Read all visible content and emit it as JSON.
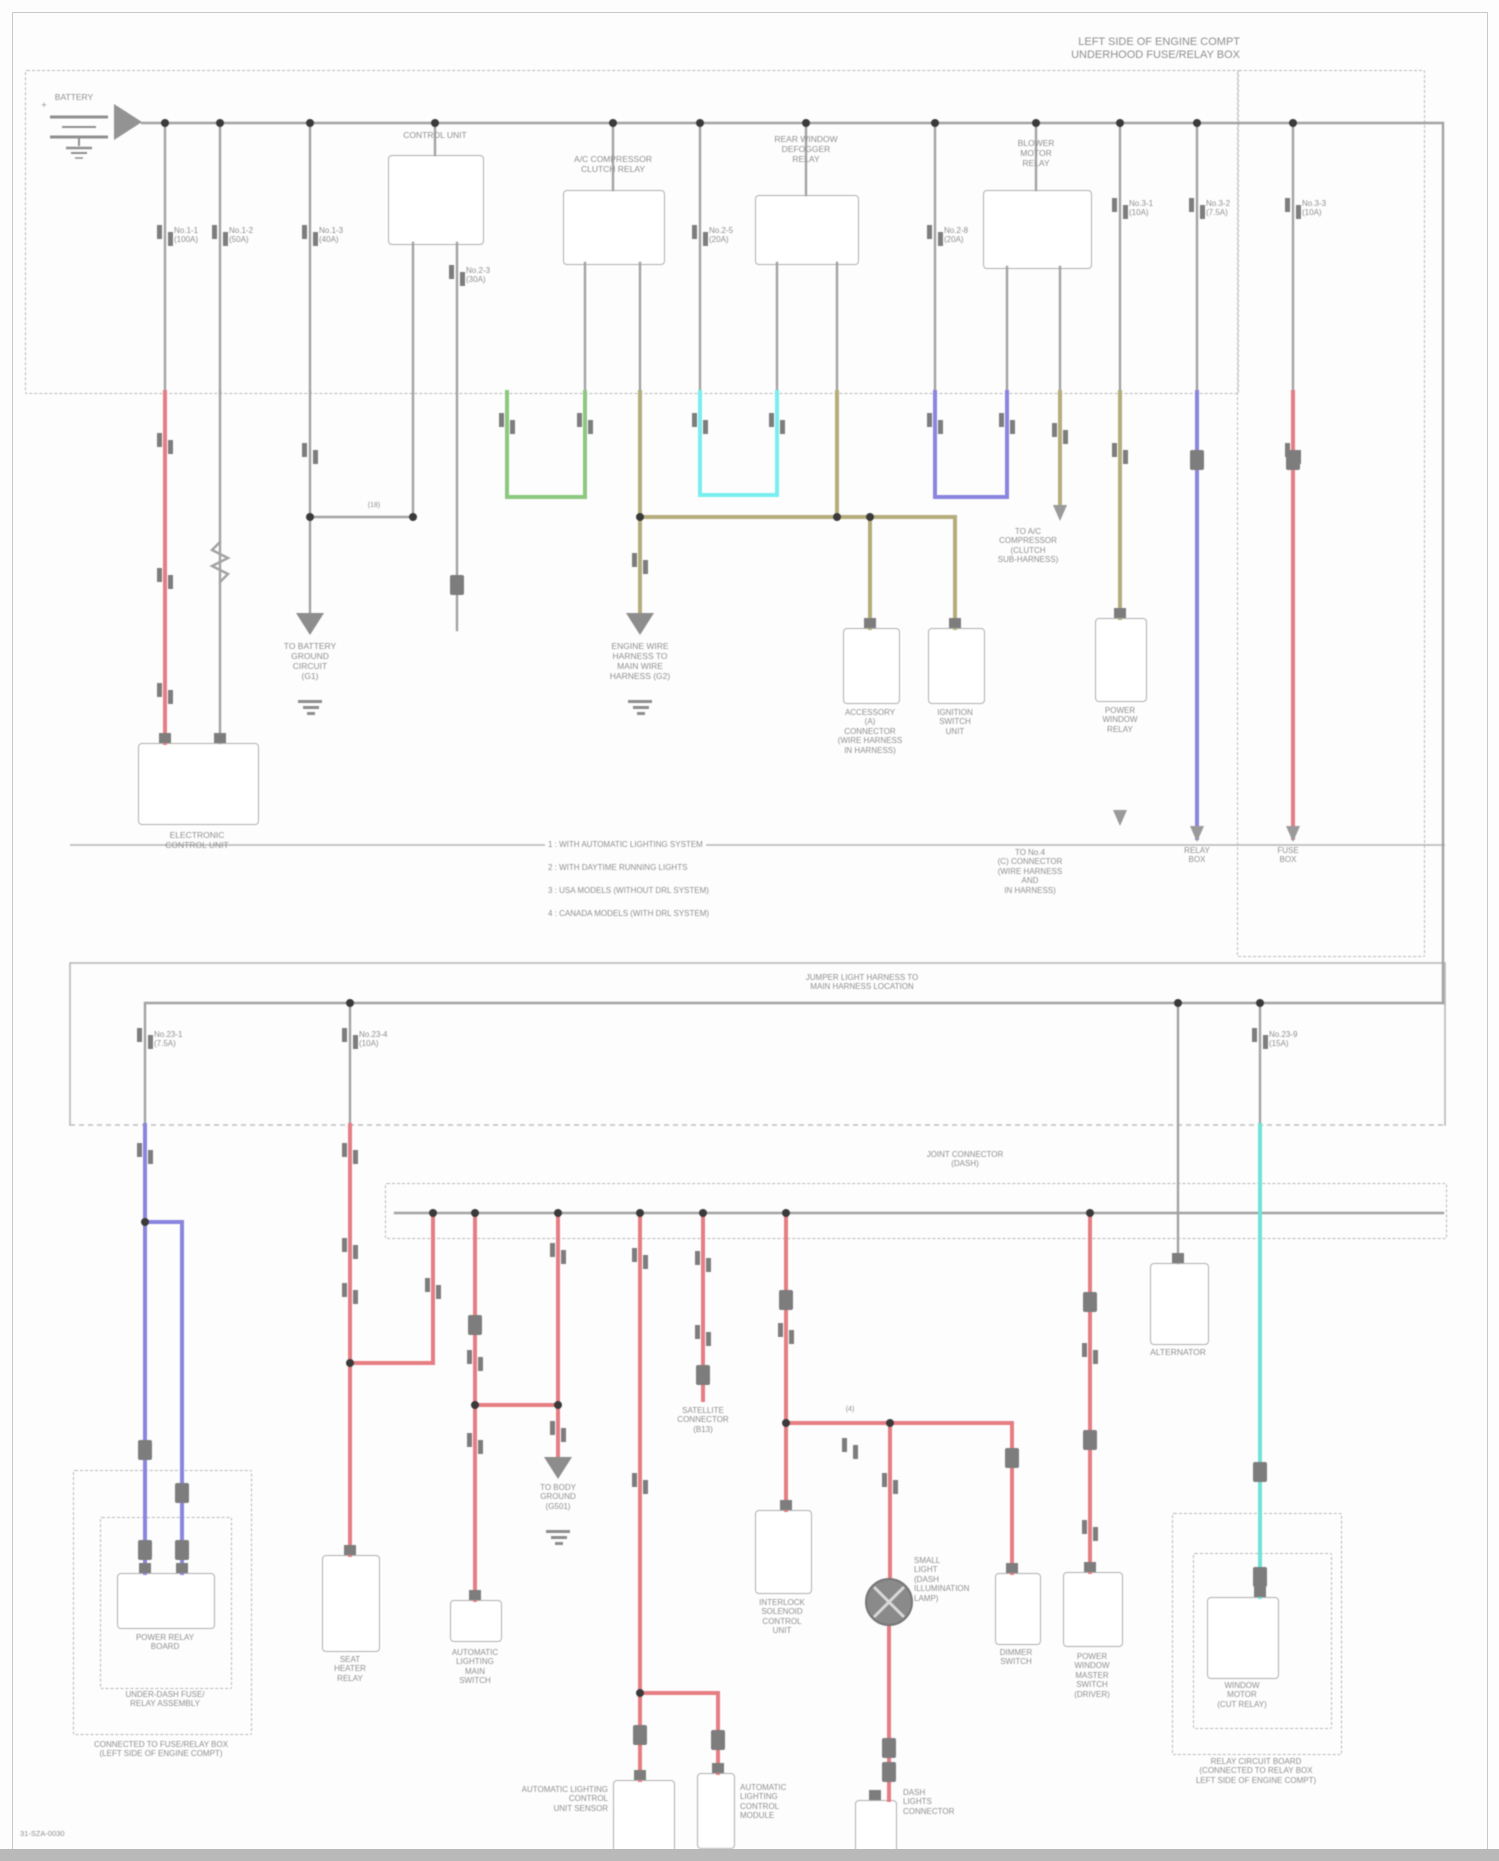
{
  "title": "POWER DISTRIBUTION WIRING DIAGRAM",
  "colors": {
    "red": "#e57d82",
    "green": "#8cc87f",
    "cyan": "#79eef0",
    "olive": "#b4ad7a",
    "blue": "#8a86e0",
    "teal": "#6fe3d6",
    "wire": "#a2a2a2",
    "text": "#8f8f8f",
    "border": "#b0b0b0"
  },
  "labels": [
    {
      "n": "corner-note",
      "x": 1240,
      "y": 36,
      "a": "r",
      "s": 11,
      "ls": [
        "LEFT SIDE OF ENGINE COMPT",
        "UNDERHOOD FUSE/RELAY BOX"
      ]
    },
    {
      "n": "battery-label",
      "x": 74,
      "y": 92,
      "a": "c",
      "ls": [
        "BATTERY"
      ]
    },
    {
      "n": "battery-plus",
      "x": 44,
      "y": 100,
      "a": "c",
      "s": 9,
      "ls": [
        "+"
      ]
    },
    {
      "n": "relay1-label",
      "x": 435,
      "y": 130,
      "a": "c",
      "ls": [
        "CONTROL UNIT"
      ]
    },
    {
      "n": "relay2-label",
      "x": 613,
      "y": 154,
      "a": "c",
      "ls": [
        "A/C COMPRESSOR",
        "CLUTCH RELAY"
      ]
    },
    {
      "n": "relay3-label",
      "x": 806,
      "y": 134,
      "a": "c",
      "ls": [
        "REAR WINDOW",
        "DEFOGGER",
        "RELAY"
      ]
    },
    {
      "n": "relay4-label",
      "x": 1036,
      "y": 138,
      "a": "c",
      "ls": [
        "BLOWER",
        "MOTOR",
        "RELAY"
      ]
    },
    {
      "n": "fuse-label-1",
      "x": 174,
      "y": 226,
      "a": "l",
      "s": 8,
      "ls": [
        "No.1-1",
        "(100A)"
      ]
    },
    {
      "n": "fuse-label-2",
      "x": 229,
      "y": 226,
      "a": "l",
      "s": 8,
      "ls": [
        "No.1-2",
        "(50A)"
      ]
    },
    {
      "n": "fuse-label-3",
      "x": 319,
      "y": 226,
      "a": "l",
      "s": 8,
      "ls": [
        "No.1-3",
        "(40A)"
      ]
    },
    {
      "n": "fuse-label-4",
      "x": 466,
      "y": 266,
      "a": "l",
      "s": 8,
      "ls": [
        "No.2-3",
        "(30A)"
      ]
    },
    {
      "n": "fuse-label-5",
      "x": 709,
      "y": 226,
      "a": "l",
      "s": 8,
      "ls": [
        "No.2-5",
        "(20A)"
      ]
    },
    {
      "n": "fuse-label-6",
      "x": 944,
      "y": 226,
      "a": "l",
      "s": 8,
      "ls": [
        "No.2-8",
        "(20A)"
      ]
    },
    {
      "n": "fuse-label-7",
      "x": 1129,
      "y": 199,
      "a": "l",
      "s": 8,
      "ls": [
        "No.3-1",
        "(10A)"
      ]
    },
    {
      "n": "fuse-label-8",
      "x": 1206,
      "y": 199,
      "a": "l",
      "s": 8,
      "ls": [
        "No.3-2",
        "(7.5A)"
      ]
    },
    {
      "n": "fuse-label-9",
      "x": 1302,
      "y": 199,
      "a": "l",
      "s": 8,
      "ls": [
        "No.3-3",
        "(10A)"
      ]
    },
    {
      "n": "fuse-label-10",
      "x": 154,
      "y": 1030,
      "a": "l",
      "s": 8,
      "ls": [
        "No.23-1",
        "(7.5A)"
      ]
    },
    {
      "n": "fuse-label-11",
      "x": 359,
      "y": 1030,
      "a": "l",
      "s": 8,
      "ls": [
        "No.23-4",
        "(10A)"
      ]
    },
    {
      "n": "fuse-label-12",
      "x": 1269,
      "y": 1030,
      "a": "l",
      "s": 8,
      "ls": [
        "No.23-9",
        "(15A)"
      ]
    },
    {
      "n": "ground1-label",
      "x": 310,
      "y": 641,
      "a": "c",
      "ls": [
        "TO BATTERY",
        "GROUND",
        "CIRCUIT",
        "(G1)"
      ]
    },
    {
      "n": "ground2-label",
      "x": 640,
      "y": 641,
      "a": "c",
      "ls": [
        "ENGINE WIRE",
        "HARNESS TO",
        "MAIN WIRE",
        "HARNESS (G2)"
      ]
    },
    {
      "n": "link-18-label",
      "x": 374,
      "y": 502,
      "a": "c",
      "s": 7,
      "ls": [
        "(18)"
      ]
    },
    {
      "n": "ecu-label",
      "x": 197,
      "y": 830,
      "a": "c",
      "ls": [
        "ELECTRONIC",
        "CONTROL UNIT"
      ]
    },
    {
      "n": "connector-a-label",
      "x": 870,
      "y": 708,
      "a": "c",
      "s": 8,
      "ls": [
        "ACCESSORY",
        "(A)",
        "CONNECTOR",
        "(WIRE HARNESS",
        "IN HARNESS)"
      ]
    },
    {
      "n": "ignition-unit-label",
      "x": 955,
      "y": 708,
      "a": "c",
      "s": 8,
      "ls": [
        "IGNITION",
        "SWITCH",
        "UNIT"
      ]
    },
    {
      "n": "power-window-relay-label",
      "x": 1120,
      "y": 706,
      "a": "c",
      "s": 8,
      "ls": [
        "POWER",
        "WINDOW",
        "RELAY"
      ]
    },
    {
      "n": "to-compressor-label",
      "x": 1028,
      "y": 527,
      "a": "c",
      "s": 8,
      "ls": [
        "TO A/C",
        "COMPRESSOR",
        "(CLUTCH",
        "SUB-HARNESS)"
      ]
    },
    {
      "n": "to-connector-note",
      "x": 1030,
      "y": 848,
      "a": "c",
      "s": 8,
      "ls": [
        "TO No.4",
        "(C) CONNECTOR",
        "(WIRE HARNESS",
        "AND",
        "IN HARNESS)"
      ]
    },
    {
      "n": "relay-box-ref-label",
      "x": 1197,
      "y": 846,
      "a": "c",
      "s": 8,
      "ls": [
        "RELAY",
        "BOX"
      ]
    },
    {
      "n": "fuse-box-ref-label",
      "x": 1288,
      "y": 846,
      "a": "c",
      "s": 8,
      "ls": [
        "FUSE",
        "BOX"
      ]
    },
    {
      "n": "legend-row-1",
      "x": 545,
      "y": 840,
      "a": "l",
      "s": 8,
      "b": 1,
      "ls": [
        "1 : WITH AUTOMATIC LIGHTING SYSTEM"
      ]
    },
    {
      "n": "legend-row-2",
      "x": 545,
      "y": 863,
      "a": "l",
      "s": 8,
      "b": 1,
      "ls": [
        "2 : WITH DAYTIME RUNNING LIGHTS"
      ]
    },
    {
      "n": "legend-row-3",
      "x": 545,
      "y": 886,
      "a": "l",
      "s": 8,
      "b": 1,
      "ls": [
        "3 : USA MODELS (WITHOUT DRL SYSTEM)"
      ]
    },
    {
      "n": "legend-row-4",
      "x": 545,
      "y": 909,
      "a": "l",
      "s": 8,
      "b": 1,
      "ls": [
        "4 : CANADA MODELS (WITH DRL SYSTEM)"
      ]
    },
    {
      "n": "jumper-harness-note",
      "x": 862,
      "y": 973,
      "a": "c",
      "s": 8,
      "ls": [
        "JUMPER LIGHT HARNESS TO",
        "MAIN HARNESS LOCATION"
      ]
    },
    {
      "n": "joint-connector-label",
      "x": 965,
      "y": 1150,
      "a": "c",
      "s": 8,
      "ls": [
        "JOINT CONNECTOR",
        "(DASH)"
      ]
    },
    {
      "n": "alternator-label",
      "x": 1178,
      "y": 1347,
      "a": "c",
      "ls": [
        "ALTERNATOR"
      ]
    },
    {
      "n": "satellite-connector-label",
      "x": 703,
      "y": 1406,
      "a": "c",
      "s": 8,
      "ls": [
        "SATELLITE",
        "CONNECTOR",
        "(B13)"
      ]
    },
    {
      "n": "link-4-label",
      "x": 850,
      "y": 1406,
      "a": "c",
      "s": 7,
      "ls": [
        "(4)"
      ]
    },
    {
      "n": "ground3-label",
      "x": 558,
      "y": 1483,
      "a": "c",
      "s": 8,
      "ls": [
        "TO BODY",
        "GROUND",
        "(G501)"
      ]
    },
    {
      "n": "seat-heater-relay-label",
      "x": 350,
      "y": 1655,
      "a": "c",
      "s": 8,
      "ls": [
        "SEAT",
        "HEATER",
        "RELAY"
      ]
    },
    {
      "n": "lighting-switch-label",
      "x": 475,
      "y": 1648,
      "a": "c",
      "s": 8,
      "ls": [
        "AUTOMATIC",
        "LIGHTING",
        "MAIN",
        "SWITCH"
      ]
    },
    {
      "n": "interlock-unit-label",
      "x": 782,
      "y": 1598,
      "a": "c",
      "s": 8,
      "ls": [
        "INTERLOCK",
        "SOLENOID",
        "CONTROL",
        "UNIT"
      ]
    },
    {
      "n": "small-light-label",
      "x": 914,
      "y": 1556,
      "a": "l",
      "s": 8,
      "ls": [
        "SMALL",
        "LIGHT",
        "(DASH",
        "ILLUMINATION",
        "LAMP)"
      ]
    },
    {
      "n": "dash-lights-label",
      "x": 903,
      "y": 1788,
      "a": "l",
      "s": 8,
      "ls": [
        "DASH",
        "LIGHTS",
        "CONNECTOR"
      ]
    },
    {
      "n": "lighting-module-label",
      "x": 740,
      "y": 1783,
      "a": "l",
      "s": 8,
      "ls": [
        "AUTOMATIC",
        "LIGHTING",
        "CONTROL",
        "MODULE"
      ]
    },
    {
      "n": "lighting-sensor-label",
      "x": 608,
      "y": 1785,
      "a": "r",
      "s": 8,
      "ls": [
        "AUTOMATIC LIGHTING",
        "CONTROL",
        "UNIT SENSOR"
      ]
    },
    {
      "n": "window-master-switch-label",
      "x": 1092,
      "y": 1652,
      "a": "c",
      "s": 8,
      "ls": [
        "POWER",
        "WINDOW",
        "MASTER",
        "SWITCH",
        "(DRIVER)"
      ]
    },
    {
      "n": "dimmer-switch-label",
      "x": 1016,
      "y": 1648,
      "a": "c",
      "s": 8,
      "ls": [
        "DIMMER",
        "SWITCH"
      ]
    },
    {
      "n": "relay-board-label",
      "x": 165,
      "y": 1633,
      "a": "c",
      "s": 8,
      "ls": [
        "POWER RELAY",
        "BOARD"
      ]
    },
    {
      "n": "underdash-box-label",
      "x": 165,
      "y": 1690,
      "a": "c",
      "s": 8,
      "ls": [
        "UNDER-DASH FUSE/",
        "RELAY ASSEMBLY"
      ]
    },
    {
      "n": "bl-outer-label",
      "x": 161,
      "y": 1740,
      "a": "c",
      "s": 8,
      "ls": [
        "CONNECTED TO FUSE/RELAY BOX",
        "(LEFT SIDE OF ENGINE COMPT)"
      ]
    },
    {
      "n": "window-motor-label",
      "x": 1242,
      "y": 1681,
      "a": "c",
      "s": 8,
      "ls": [
        "WINDOW",
        "MOTOR",
        "(CUT RELAY)"
      ]
    },
    {
      "n": "br-outer-label",
      "x": 1256,
      "y": 1757,
      "a": "c",
      "s": 8,
      "ls": [
        "RELAY CIRCUIT BOARD",
        "(CONNECTED TO RELAY BOX",
        "LEFT SIDE OF ENGINE COMPT)"
      ]
    },
    {
      "n": "doc-code",
      "x": 20,
      "y": 1830,
      "a": "l",
      "s": 7.5,
      "ls": [
        "31-SZA-0030"
      ]
    }
  ],
  "boxes": [
    {
      "n": "relay1-box",
      "t": "s",
      "x": 388,
      "y": 155,
      "w": 94,
      "h": 88
    },
    {
      "n": "relay2-box",
      "t": "s",
      "x": 563,
      "y": 190,
      "w": 100,
      "h": 73
    },
    {
      "n": "relay3-box",
      "t": "s",
      "x": 755,
      "y": 195,
      "w": 102,
      "h": 68
    },
    {
      "n": "relay4-box",
      "t": "s",
      "x": 983,
      "y": 190,
      "w": 107,
      "h": 77
    },
    {
      "n": "ecu-box",
      "t": "s",
      "x": 138,
      "y": 743,
      "w": 119,
      "h": 80
    },
    {
      "n": "connector-a-box",
      "t": "s",
      "x": 843,
      "y": 628,
      "w": 55,
      "h": 74
    },
    {
      "n": "ignition-unit-box",
      "t": "s",
      "x": 928,
      "y": 628,
      "w": 55,
      "h": 74
    },
    {
      "n": "power-window-relay-box",
      "t": "s",
      "x": 1095,
      "y": 618,
      "w": 50,
      "h": 82
    },
    {
      "n": "alternator-box",
      "t": "s",
      "x": 1150,
      "y": 1263,
      "w": 57,
      "h": 80
    },
    {
      "n": "seat-heater-relay-box",
      "t": "s",
      "x": 322,
      "y": 1555,
      "w": 56,
      "h": 95
    },
    {
      "n": "lighting-switch-box",
      "t": "s",
      "x": 450,
      "y": 1600,
      "w": 50,
      "h": 40
    },
    {
      "n": "interlock-unit-box",
      "t": "s",
      "x": 755,
      "y": 1510,
      "w": 55,
      "h": 82
    },
    {
      "n": "dash-lights-box",
      "t": "s",
      "x": 855,
      "y": 1800,
      "w": 40,
      "h": 56
    },
    {
      "n": "window-master-switch-box",
      "t": "s",
      "x": 1063,
      "y": 1572,
      "w": 58,
      "h": 73
    },
    {
      "n": "dimmer-switch-box",
      "t": "s",
      "x": 995,
      "y": 1573,
      "w": 44,
      "h": 70
    },
    {
      "n": "lighting-module-box",
      "t": "s",
      "x": 697,
      "y": 1773,
      "w": 36,
      "h": 74
    },
    {
      "n": "lighting-sensor-box",
      "t": "s",
      "x": 613,
      "y": 1780,
      "w": 60,
      "h": 73
    },
    {
      "n": "bl-relay-board-box",
      "t": "s",
      "x": 117,
      "y": 1573,
      "w": 96,
      "h": 54
    },
    {
      "n": "br-window-motor-box",
      "t": "s",
      "x": 1207,
      "y": 1597,
      "w": 70,
      "h": 80
    },
    {
      "n": "top-fusebox-outline",
      "t": "d",
      "x": 25,
      "y": 70,
      "w": 1212,
      "h": 322
    },
    {
      "n": "right-column-outline",
      "t": "d",
      "x": 1237,
      "y": 70,
      "w": 186,
      "h": 885
    },
    {
      "n": "joint-connector-outline",
      "t": "d",
      "x": 385,
      "y": 1183,
      "w": 1060,
      "h": 54
    },
    {
      "n": "bl-outer-outline",
      "t": "d",
      "x": 73,
      "y": 1470,
      "w": 177,
      "h": 263
    },
    {
      "n": "bl-inner-outline",
      "t": "d",
      "x": 100,
      "y": 1517,
      "w": 130,
      "h": 170
    },
    {
      "n": "br-outer-outline",
      "t": "d",
      "x": 1172,
      "y": 1513,
      "w": 168,
      "h": 240
    },
    {
      "n": "br-inner-outline",
      "t": "d",
      "x": 1193,
      "y": 1553,
      "w": 137,
      "h": 174
    }
  ]
}
